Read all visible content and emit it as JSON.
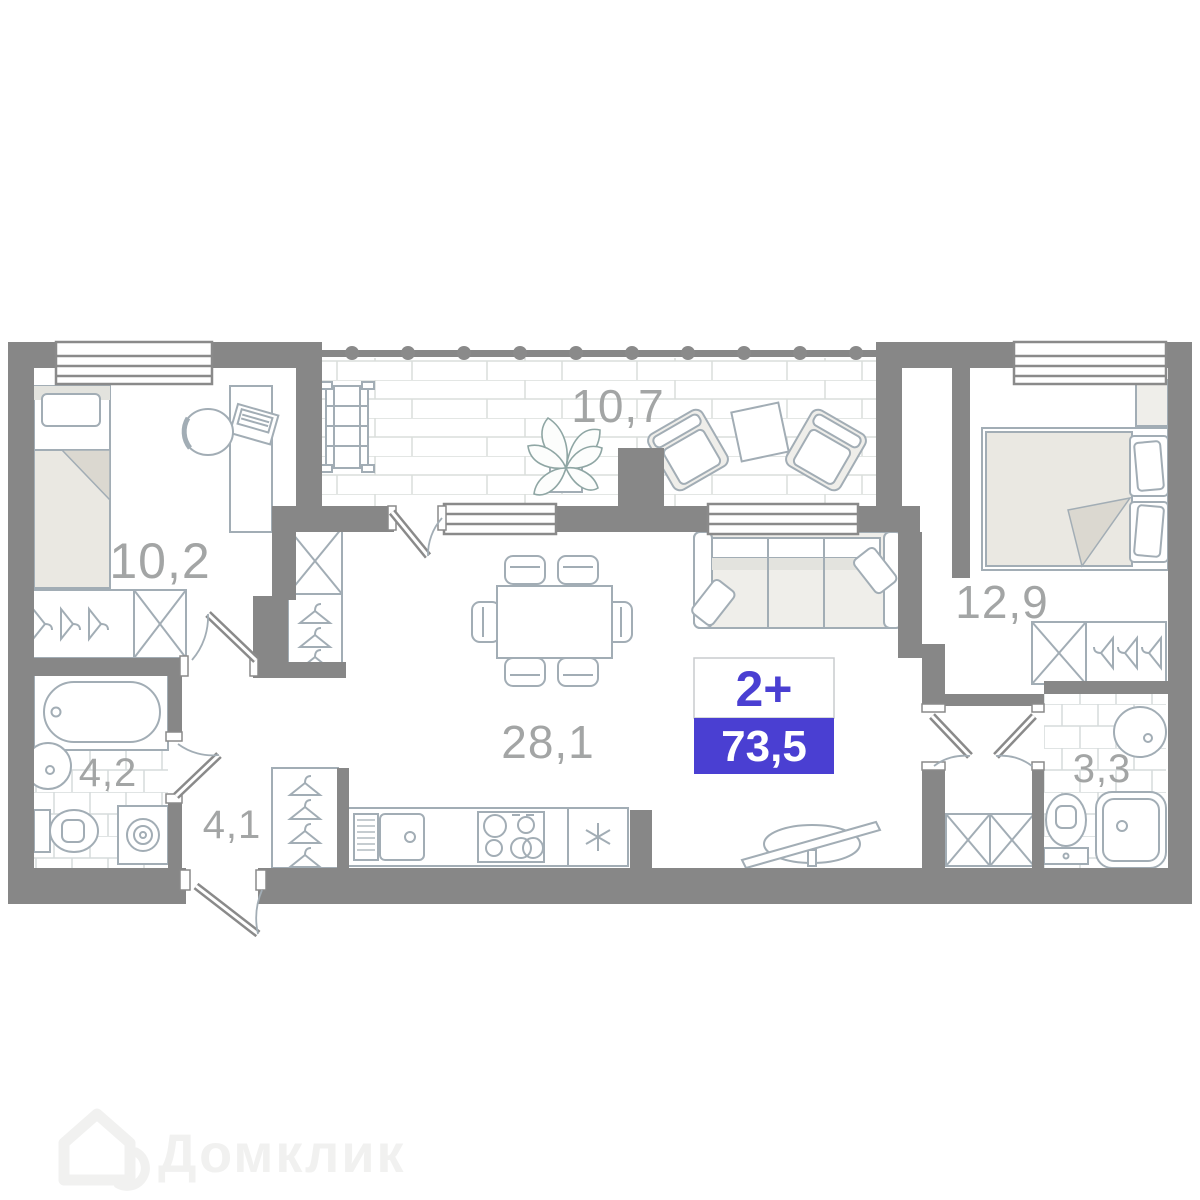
{
  "plan": {
    "badge": {
      "type_label": "2+",
      "total_area": "73,5"
    },
    "rooms": [
      {
        "key": "bedroom-small",
        "area_label": "10,2"
      },
      {
        "key": "balcony",
        "area_label": "10,7"
      },
      {
        "key": "bedroom-master",
        "area_label": "12,9"
      },
      {
        "key": "living-kitchen",
        "area_label": "28,1"
      },
      {
        "key": "bathroom",
        "area_label": "4,2"
      },
      {
        "key": "hallway",
        "area_label": "4,1"
      },
      {
        "key": "wc",
        "area_label": "3,3"
      }
    ],
    "watermark": {
      "brand": "Домклик"
    },
    "colors": {
      "accent": "#4a3fd2",
      "wall": "#878787",
      "furniture-line": "#a2adb5",
      "room-label": "#a3a5a5",
      "watermark": "#f1f1f0"
    }
  }
}
